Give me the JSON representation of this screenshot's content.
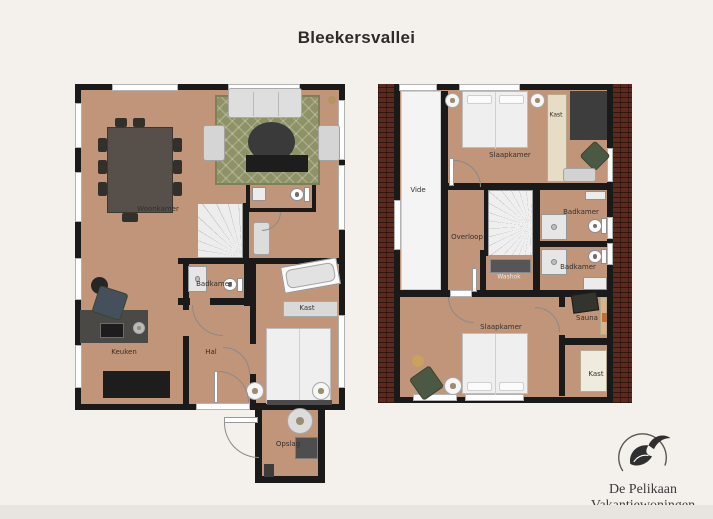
{
  "title": "Bleekersvallei",
  "ground_floor": {
    "rooms": {
      "woonkamer": "Woonkamer",
      "badkamer": "Badkamer",
      "kast": "Kast",
      "hal": "Hal",
      "keuken": "Keuken",
      "opslag": "Opslag"
    }
  },
  "first_floor": {
    "rooms": {
      "vide": "Vide",
      "slaapkamer_top": "Slaapkamer",
      "kast_top": "Kast",
      "overloop": "Overloop",
      "washok": "Washok",
      "badkamer_top": "Badkamer",
      "badkamer_bottom": "Badkamer",
      "sauna": "Sauna",
      "slaapkamer_bottom": "Slaapkamer",
      "kast_bottom": "Kast"
    }
  },
  "logo": {
    "icon": "pelican-icon",
    "name_line1": "De Pelikaan",
    "name_line2": "Vakantiewoningen",
    "tagline": "Comfortabel genieten"
  },
  "colors": {
    "background": "#f4f1ec",
    "wall": "#1a1a1a",
    "floor": "#c0957a",
    "vide": "#f4f4f4",
    "rug": "#8e9266",
    "brick": "#5a2a1e"
  }
}
